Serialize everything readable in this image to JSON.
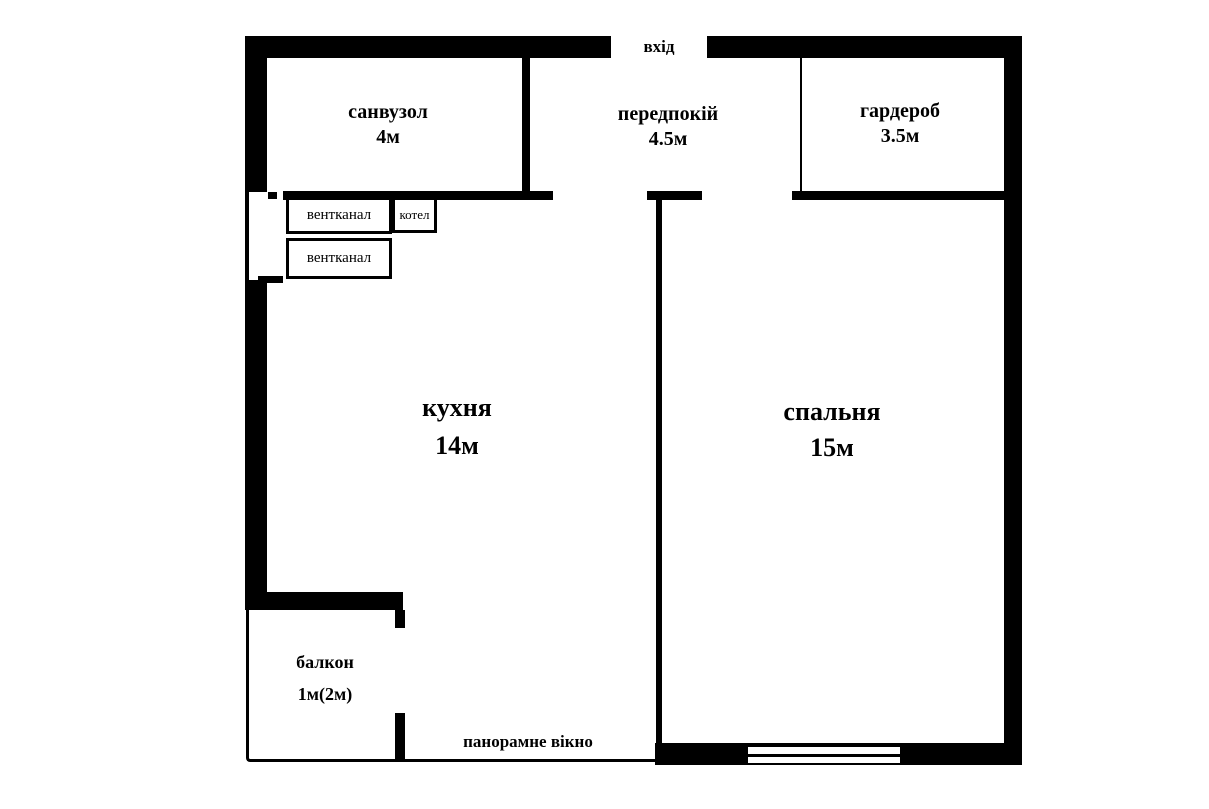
{
  "entrance": {
    "label": "вхід"
  },
  "rooms": {
    "bathroom": {
      "name": "санвузол",
      "area": "4м"
    },
    "hallway": {
      "name": "передпокій",
      "area": "4.5м"
    },
    "wardrobe": {
      "name": "гардероб",
      "area": "3.5м"
    },
    "kitchen": {
      "name": "кухня",
      "area": "14м"
    },
    "bedroom": {
      "name": "спальня",
      "area": "15м"
    },
    "balcony": {
      "name": "балкон",
      "area": "1м(2м)"
    }
  },
  "features": {
    "vent_channel_1": {
      "label": "вентканал"
    },
    "vent_channel_2": {
      "label": "вентканал"
    },
    "boiler": {
      "label": "котел"
    },
    "panoramic_window": {
      "label": "панорамне вікно"
    }
  },
  "colors": {
    "wall": "#000000",
    "background": "#ffffff"
  }
}
